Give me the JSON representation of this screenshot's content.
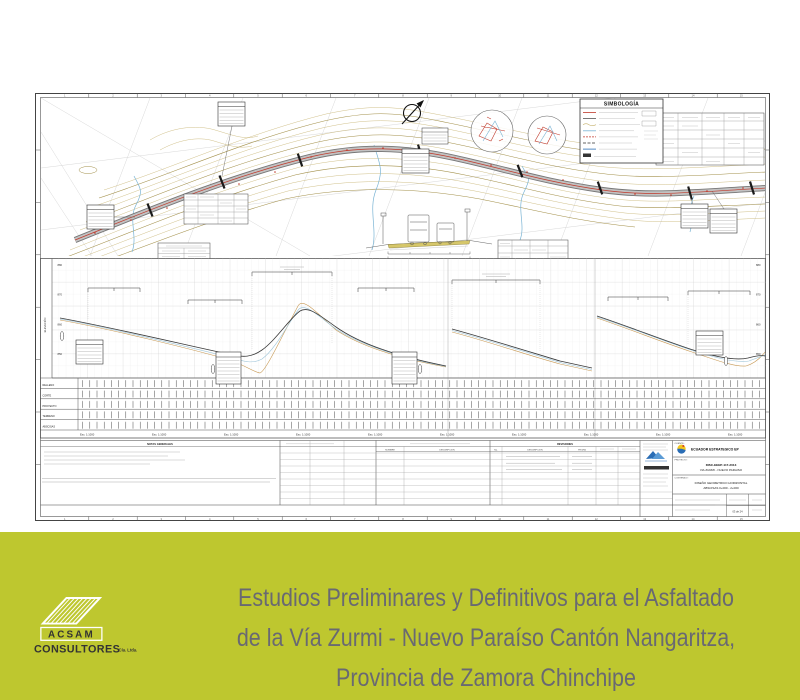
{
  "banner": {
    "bg_color": "#bec72f",
    "text_color": "#696972",
    "title_lines": [
      "Estudios Preliminares y Definitivos para el Asfaltado",
      "de la Vía Zurmi - Nuevo Paraíso Cantón Nangaritza,",
      "Provincia de Zamora Chinchipe"
    ],
    "logo": {
      "acronym": "ACSAM",
      "word": "CONSULTORES",
      "suffix": "Cía. Ltda."
    }
  },
  "sheet": {
    "legend_title": "SIMBOLOGÍA",
    "border_numbers": [
      "1",
      "2",
      "3",
      "4",
      "5",
      "6",
      "7",
      "8",
      "9",
      "10",
      "11",
      "12",
      "13",
      "14",
      "15"
    ],
    "profile": {
      "axis_label": "ELEVACIÓN",
      "row_labels": [
        "RELLENO",
        "CORTE",
        "PROYECTO",
        "TERRENO",
        "ABSCISAS"
      ],
      "scale_label": "Esc: 1:1000",
      "elevation_ticks_left": [
        "880",
        "870",
        "860",
        "850"
      ],
      "elevation_ticks_right": [
        "880",
        "870",
        "860",
        "850"
      ]
    },
    "title_block": {
      "notes_title": "NOTAS GENERALES",
      "revisions_title": "REVISIONES",
      "col_nombre": "NOMBRE",
      "col_descripcion": "DESCRIPCION",
      "col_no": "No.",
      "col_fecha": "FECHA",
      "client_label": "CLIENTE :",
      "client_name": "ECUADOR ESTRATEGICO EP",
      "project_label": "PROYECTO :",
      "project_code": "DISC-EEEP-117-2013",
      "project_name": "VIA ZURMI - NUEVO PARAISO",
      "content_label": "CONTENIDO :",
      "content_line1": "DISEÑO GEOMETRICO HORIZONTAL",
      "content_line2": "ABSCISAS 0+000 - 2+000",
      "sheet_number": "03 de 24"
    }
  }
}
